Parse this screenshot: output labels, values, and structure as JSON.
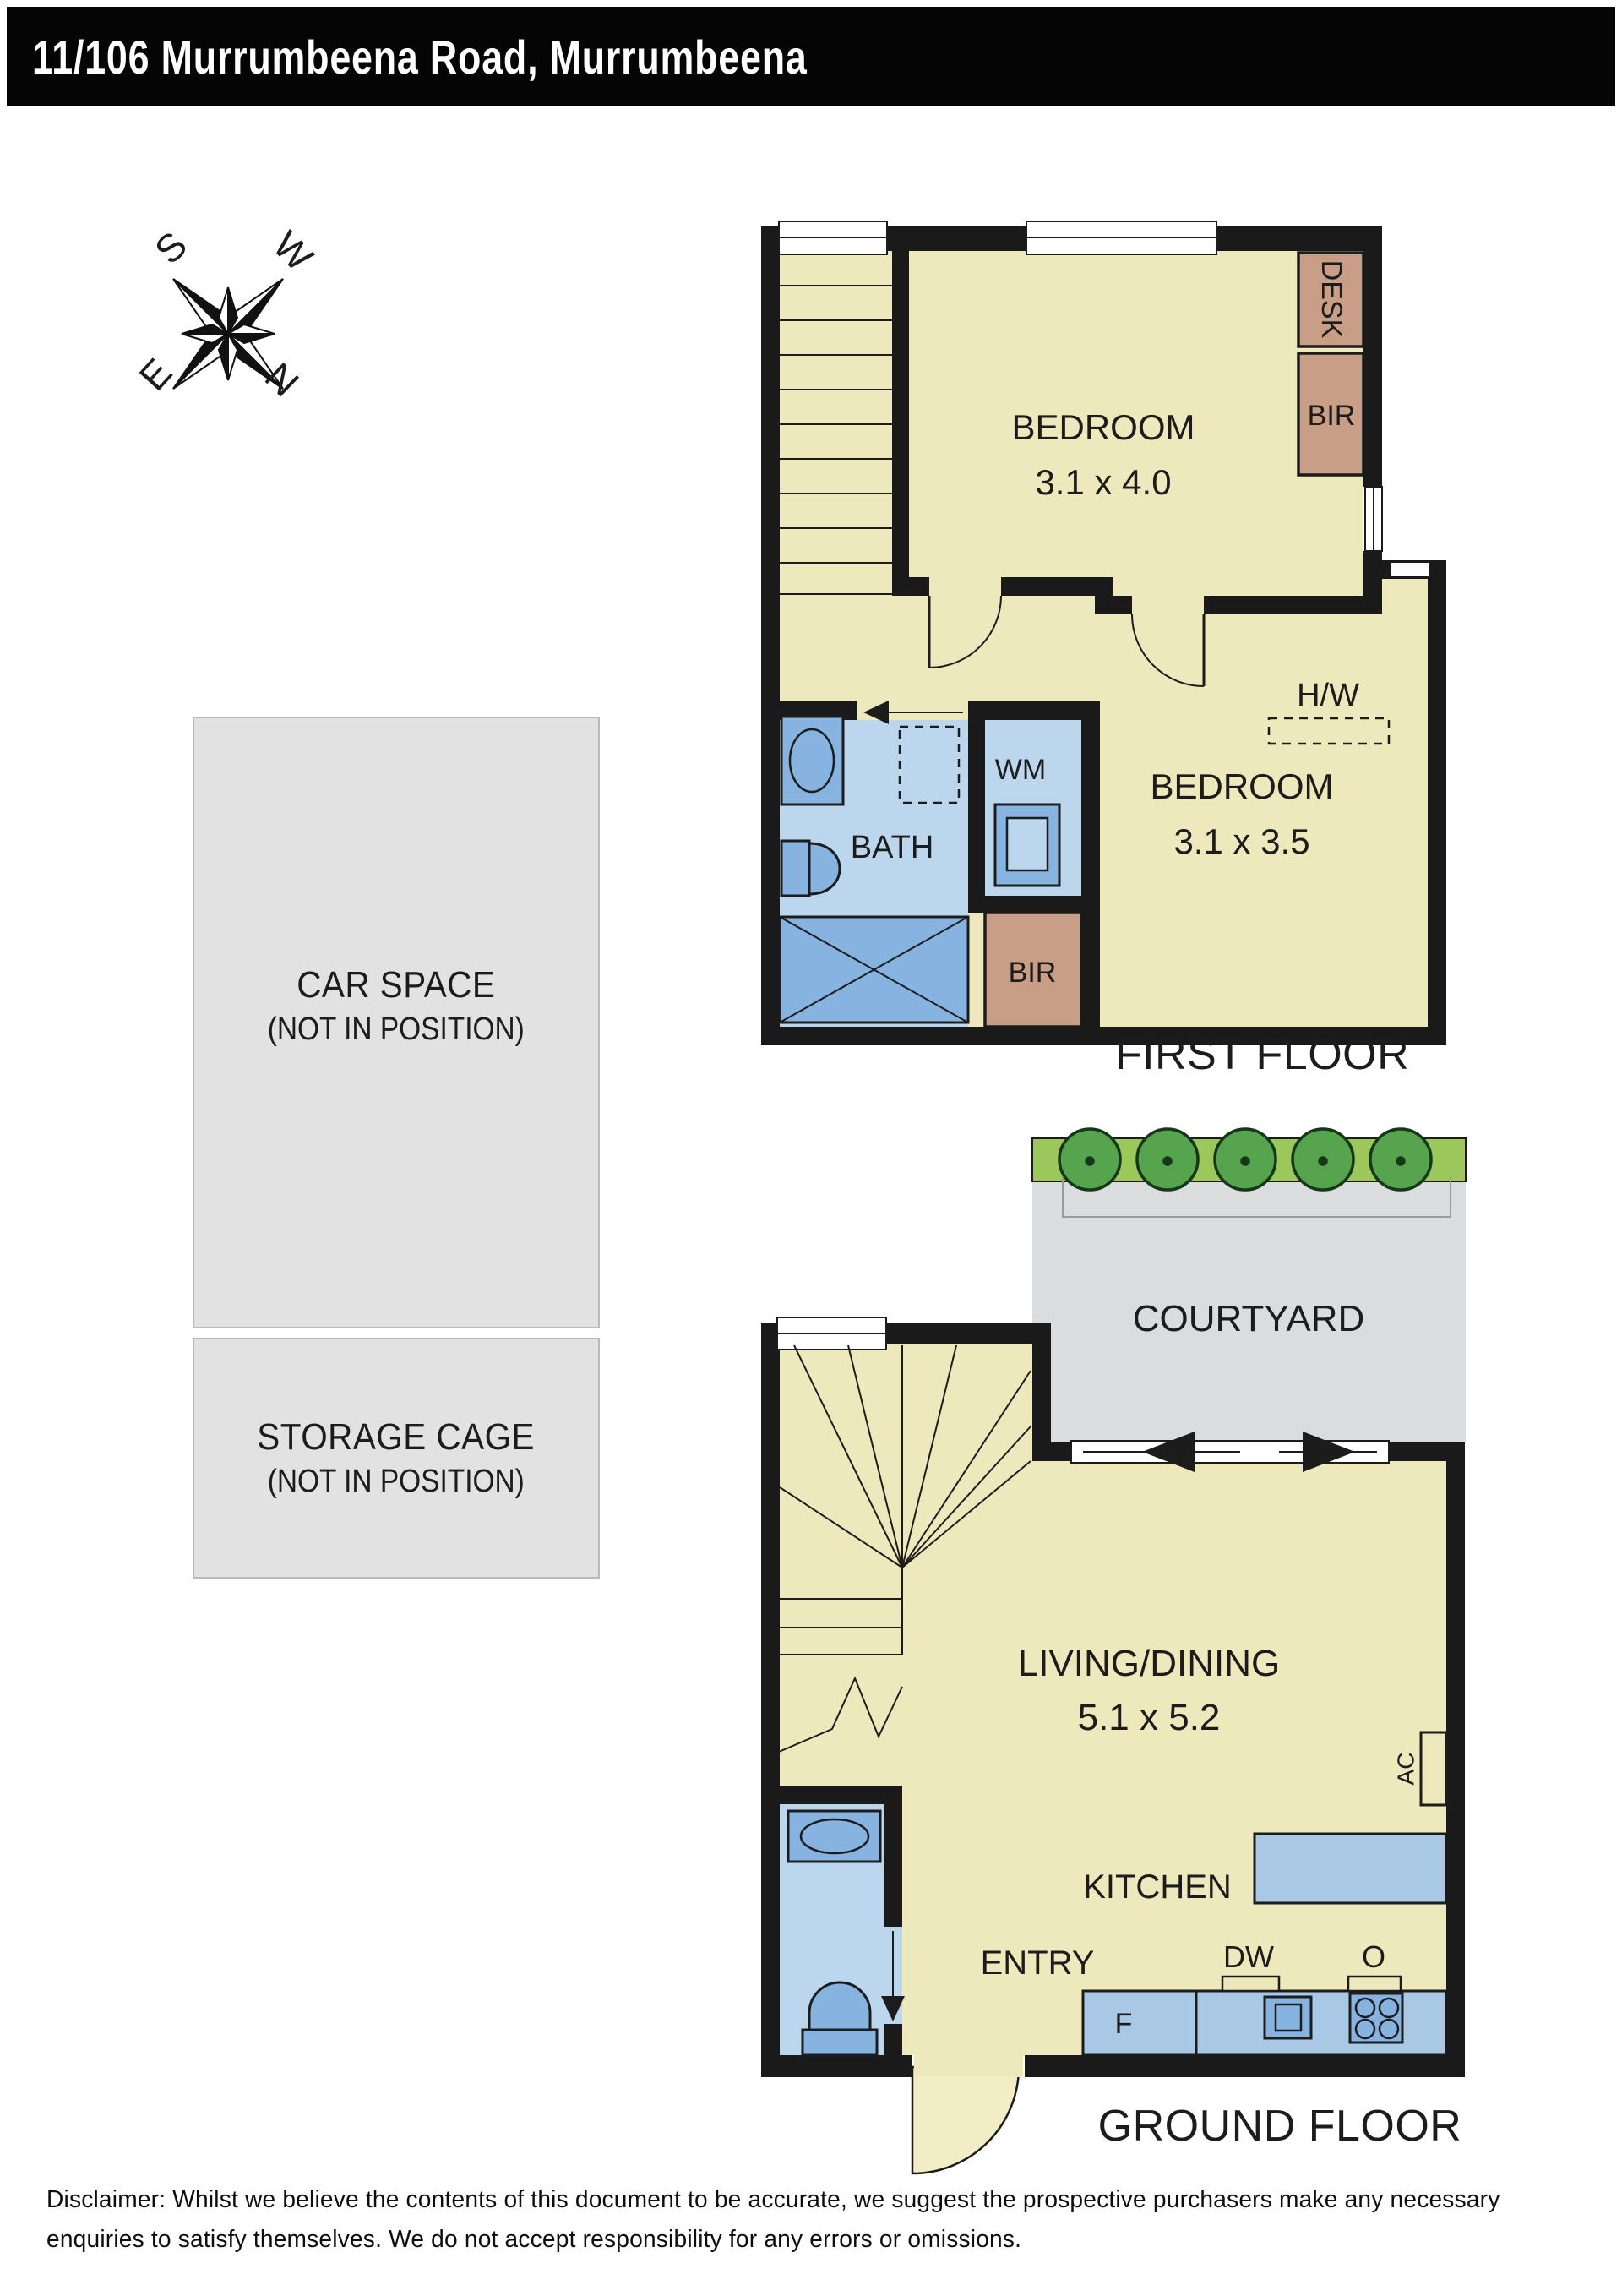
{
  "header": {
    "title": "11/106 Murrumbeena Road, Murrumbeena"
  },
  "compass": {
    "points": {
      "s": "S",
      "w": "W",
      "e": "E",
      "n": "N"
    }
  },
  "first_floor": {
    "caption": "FIRST FLOOR",
    "bedroom1": {
      "name": "BEDROOM",
      "dims": "3.1 x 4.0"
    },
    "bedroom2": {
      "name": "BEDROOM",
      "dims": "3.1 x 3.5"
    },
    "bath": "BATH",
    "wm": "WM",
    "desk": "DESK",
    "bir_top": "BIR",
    "bir_lower": "BIR",
    "hw": "H/W"
  },
  "ground_floor": {
    "caption": "GROUND FLOOR",
    "courtyard": "COURTYARD",
    "living": {
      "name": "LIVING/DINING",
      "dims": "5.1 x 5.2"
    },
    "kitchen": "KITCHEN",
    "entry": "ENTRY",
    "fridge": "F",
    "dishwasher": "DW",
    "oven": "O",
    "ac": "AC"
  },
  "parking": {
    "car_space": {
      "title": "CAR SPACE",
      "note": "(NOT IN POSITION)"
    },
    "storage_cage": {
      "title": "STORAGE CAGE",
      "note": "(NOT IN POSITION)"
    }
  },
  "disclaimer": "Disclaimer: Whilst we believe the contents of this document to be accurate, we suggest the prospective purchasers make any necessary enquiries to satisfy themselves. We do not accept responsibility for any errors or omissions.",
  "colors": {
    "wall": "#1a1a1a",
    "room": "#eee9bc",
    "wet": "#bcd6ed",
    "fixture": "#86b3e0",
    "bench": "#a9c8e6",
    "furniture": "#c89f86",
    "outdoor": "#dbdcde",
    "graybox": "#e2e2e3",
    "garden": "#9cc75b",
    "tree": "#57a44e"
  }
}
